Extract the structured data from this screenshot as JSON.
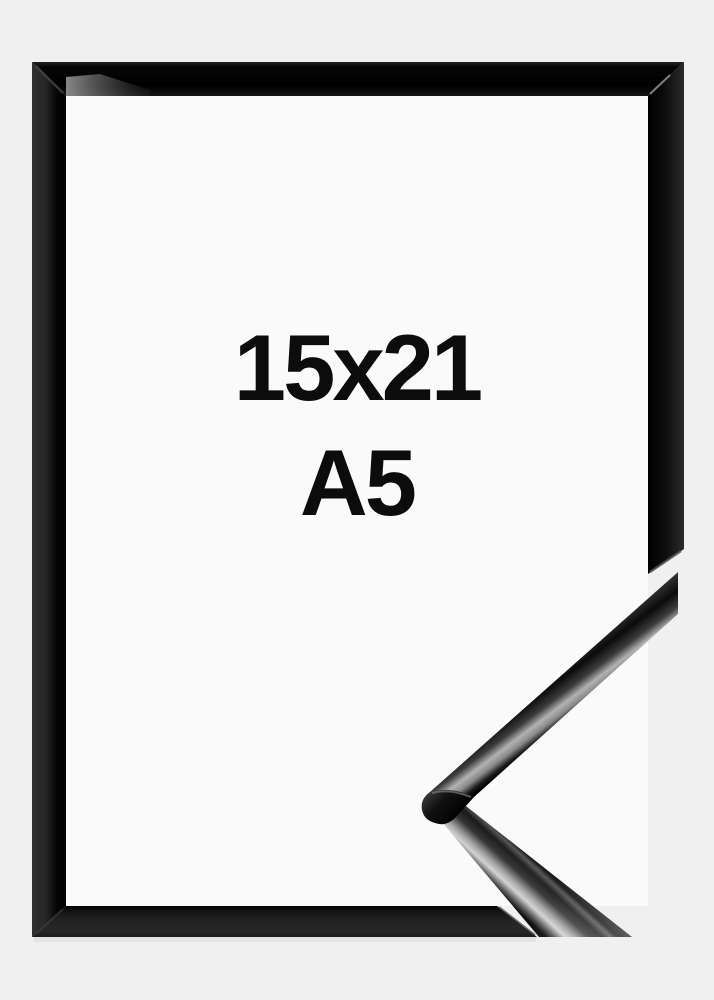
{
  "product": {
    "size_label": "15x21",
    "format_label": "A5"
  },
  "colors": {
    "background": "#f0f0f1",
    "frame_interior": "#fafafa",
    "frame_gloss_black": "#0d0d0d",
    "frame_edge_gray": "#2e2e2e",
    "detail_highlight_silver": "#d2d2d2",
    "label_text": "#0c0c0c"
  }
}
